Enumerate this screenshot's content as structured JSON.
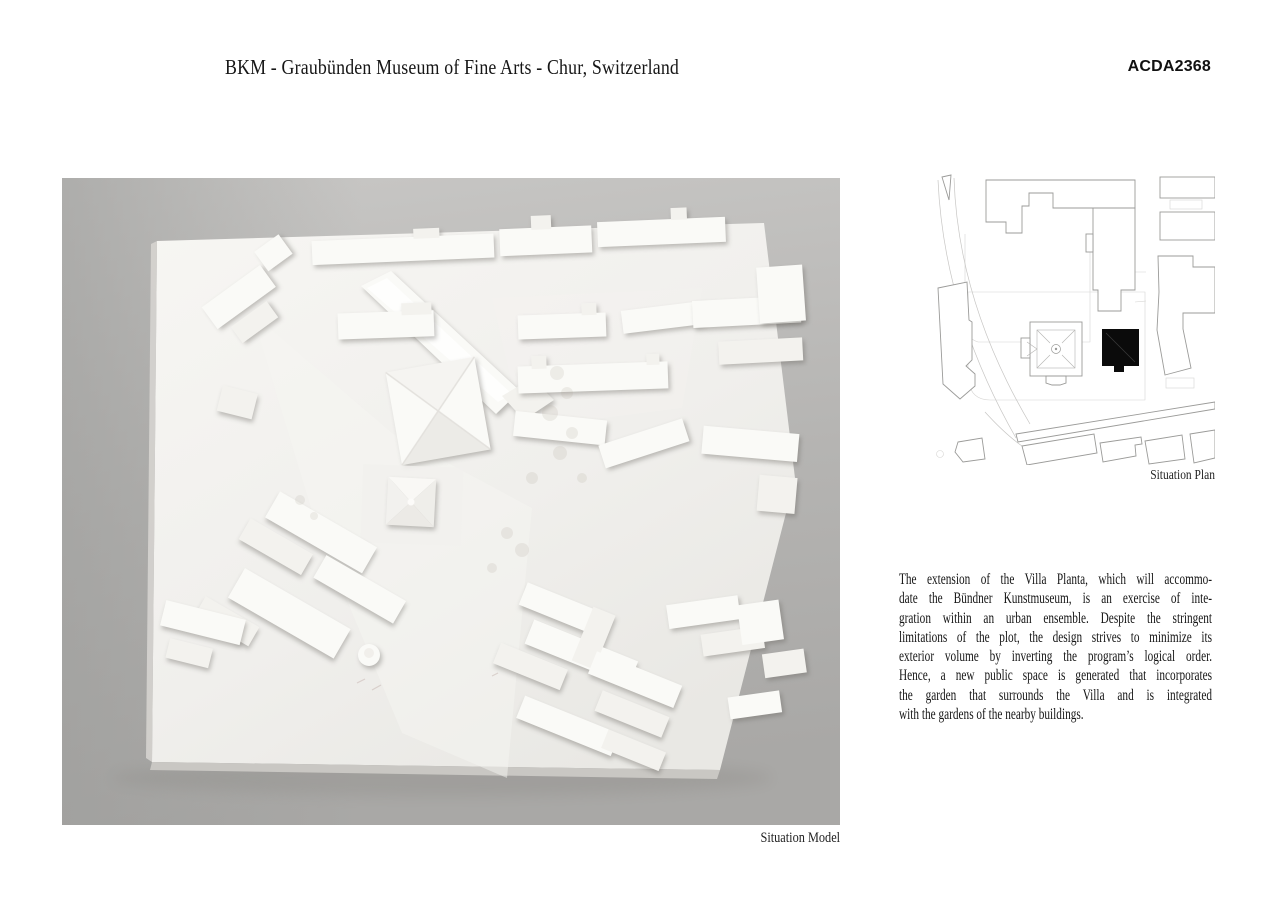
{
  "header": {
    "title": "BKM - Graubünden Museum of Fine Arts - Chur, Switzerland",
    "code": "ACDA2368"
  },
  "model_figure": {
    "caption": "Situation Model"
  },
  "plan_figure": {
    "caption": "Situation Plan"
  },
  "description": {
    "lines": [
      "The extension of the Villa Planta, which will accommo-",
      "date the Bündner Kunstmuseum, is an exercise of inte-",
      "gration within an urban ensemble. Despite the stringent",
      "limitations of the plot, the design strives to minimize its",
      "exterior volume by inverting the program’s logical order.",
      "Hence, a new public space is generated that incorporates",
      "the garden that surrounds the Villa and is integrated",
      "with the gardens of the nearby buildings."
    ]
  },
  "colors": {
    "page_background": "#ffffff",
    "text": "#1a1a1a",
    "photo_background_gray": "#b5b4b2",
    "model_white": "#f5f4f1",
    "plan_line": "#9b9b99",
    "plan_new_building": "#0b0b0b"
  }
}
